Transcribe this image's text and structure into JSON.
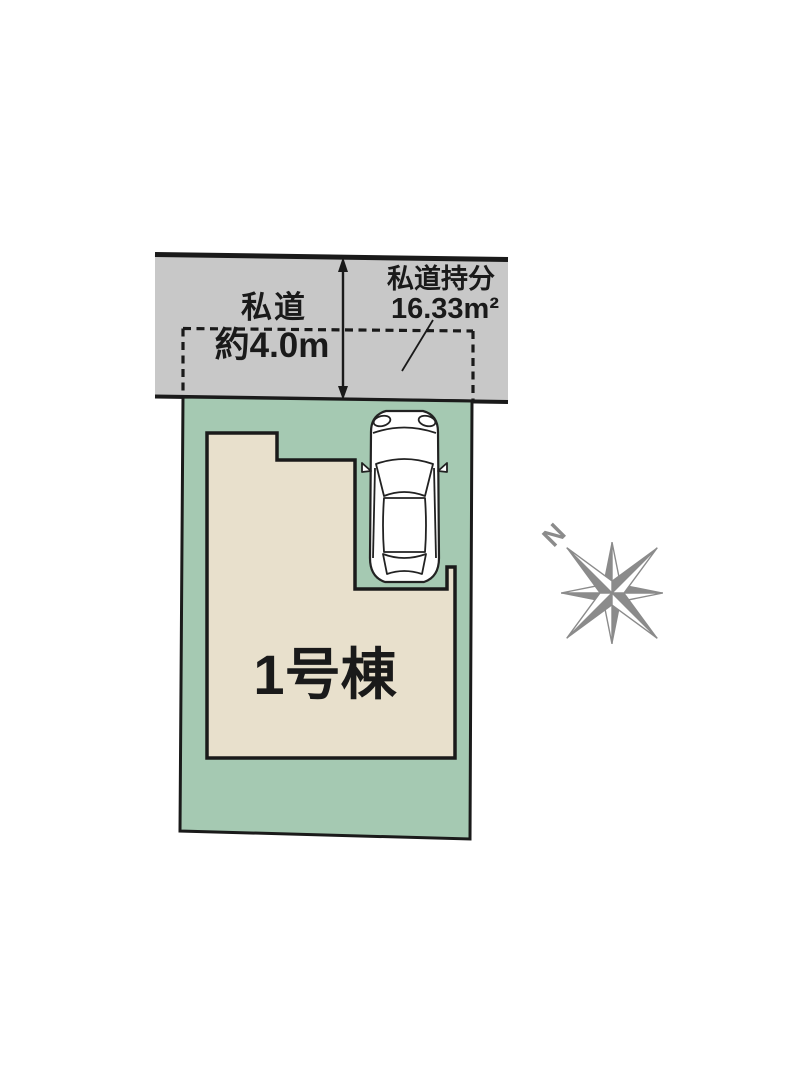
{
  "road": {
    "name_label": "私道",
    "width_label": "約4.0m",
    "share_title": "私道持分",
    "share_area": "16.33m²"
  },
  "plot": {
    "building_label": "1号棟"
  },
  "compass": {
    "north_label": "N"
  },
  "colors": {
    "road_fill": "#c8c8c8",
    "plot_fill": "#a5c9b2",
    "building_fill": "#e8e0cc",
    "line_black": "#1a1a1a",
    "text_black": "#1a1a1a",
    "car_outline": "#222222",
    "compass_gray": "#8b8b8b"
  }
}
